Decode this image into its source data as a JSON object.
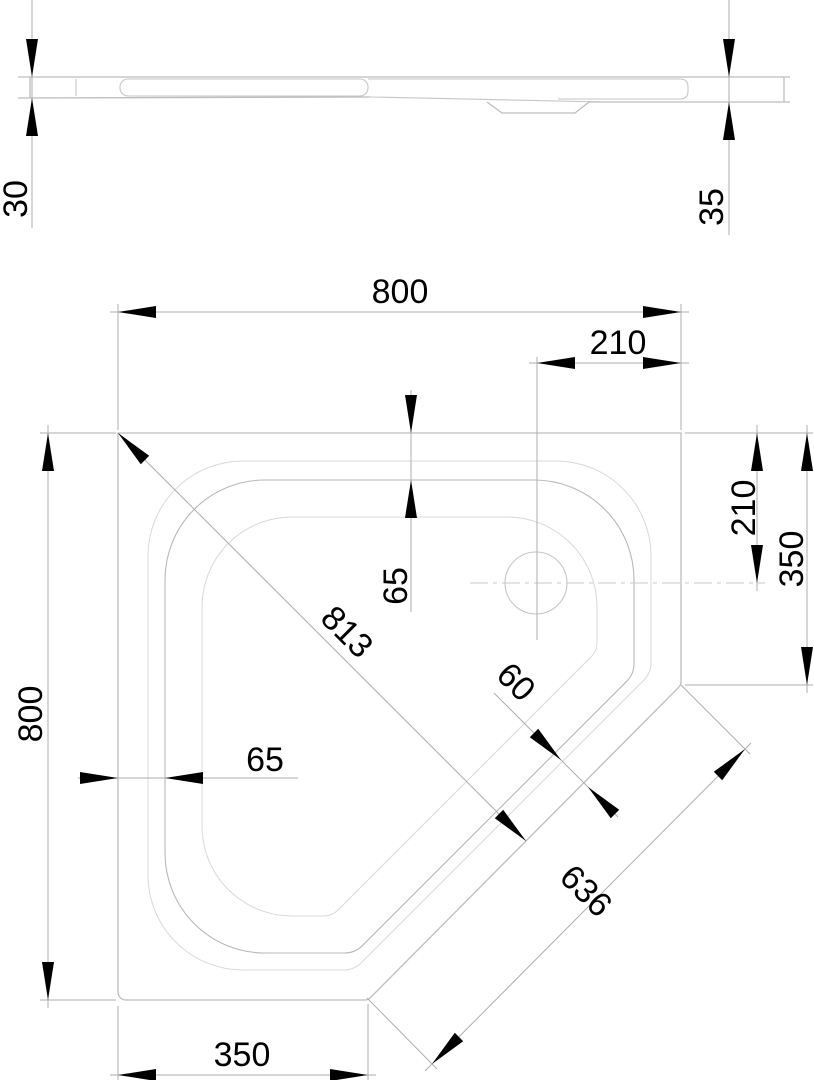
{
  "side_view": {
    "thickness_left": "30",
    "thickness_right": "35"
  },
  "plan_view": {
    "overall_width": "800",
    "overall_height": "800",
    "drain_from_right": "210",
    "drain_from_top": "210",
    "right_edge_length": "350",
    "bottom_edge_length": "350",
    "rim_width_top": "65",
    "rim_width_left": "65",
    "diagonal_length": "813",
    "diagonal_rim_width": "60",
    "cut_edge_length": "636"
  },
  "colors": {
    "background": "#ffffff",
    "drawing_line": "#bdbdbd",
    "light_line": "#d8d8d8",
    "dimension_line": "#aeaeae",
    "text": "#000000",
    "arrow": "#000000"
  }
}
